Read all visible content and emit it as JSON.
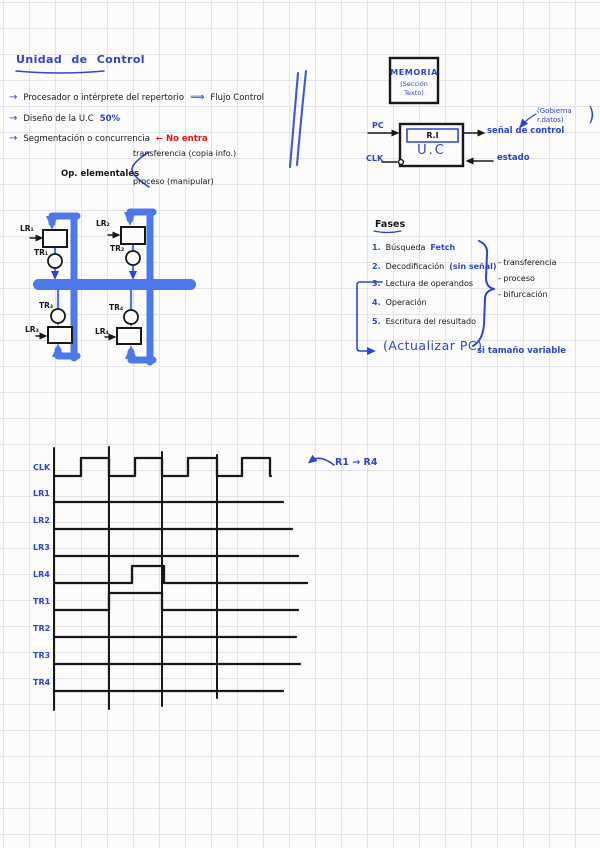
{
  "colors": {
    "ink_blue": "#2e46cf",
    "bus_blue": "#4d78ea",
    "ink_black": "#181818",
    "accent_red": "#e31616",
    "paper": "#fbfbfc",
    "grid": "#e4e4e8"
  },
  "notes": {
    "title": "Unidad de Control",
    "bullet1": {
      "arrow": "→",
      "text": "Procesador o intérprete del repertorio",
      "implies": "⟹",
      "tail": "Flujo Control"
    },
    "bullet2": {
      "arrow": "→",
      "text": "Diseño de la U.C",
      "highlight": "50%"
    },
    "bullet3": {
      "arrow": "→",
      "text": "Segmentación o concurrencia",
      "note": "← No entra"
    },
    "ops": {
      "label": "Op. elementales",
      "branch1": "transferencia (copia info.)",
      "branch2": "proceso (manipular)"
    }
  },
  "memory_diagram": {
    "box_title": "MEMORIA",
    "box_subtitle": "(Sección Texto)",
    "pc": "PC",
    "clk": "CLK",
    "ri": "R.I",
    "uc": "U.C",
    "signal_out": "señal de control",
    "signal_note": "(Gobierna r.datos)",
    "paren": ")",
    "state_out": "estado"
  },
  "register_diagram": {
    "labels": {
      "lr1": "LR₁",
      "tr1": "TR₁",
      "lr2": "LR₂",
      "tr2": "TR₂",
      "tr3": "TR₃",
      "lr3": "LR₃",
      "tr4": "TR₄",
      "lr4": "LR₄"
    }
  },
  "fases": {
    "title": "Fases",
    "items": [
      {
        "num": "1.",
        "text": "Búsqueda",
        "note": "Fetch"
      },
      {
        "num": "2.",
        "text": "Decodificación",
        "note": "(sin señal)"
      },
      {
        "num": "3.",
        "text": "Lectura de operandos",
        "note": ""
      },
      {
        "num": "4.",
        "text": "Operación",
        "note": ""
      },
      {
        "num": "5.",
        "text": "Escritura del resultado",
        "note": ""
      }
    ],
    "side_items": [
      "- transferencia",
      "- proceso",
      "- bifurcación"
    ],
    "footnote": {
      "main": "(Actualizar PC)",
      "detail": "si tamaño variable"
    }
  },
  "timing": {
    "type": "logic-waveform",
    "annotation": "R1 → R4",
    "x_start": 54,
    "clk_end": 270,
    "pulse_height": 17,
    "clock": {
      "name": "CLK",
      "baseline_y": 476,
      "high_y": 458,
      "edges": [
        81,
        109,
        135,
        162,
        188,
        217,
        242,
        270
      ]
    },
    "signals": [
      {
        "name": "LR1",
        "y": 502,
        "end": 283,
        "pulses": []
      },
      {
        "name": "LR2",
        "y": 529,
        "end": 292,
        "pulses": []
      },
      {
        "name": "LR3",
        "y": 556,
        "end": 298,
        "pulses": []
      },
      {
        "name": "LR4",
        "y": 583,
        "end": 307,
        "pulses": [
          [
            132,
            164
          ]
        ]
      },
      {
        "name": "TR1",
        "y": 610,
        "end": 298,
        "pulses": [
          [
            109,
            162
          ]
        ]
      },
      {
        "name": "TR2",
        "y": 637,
        "end": 296,
        "pulses": []
      },
      {
        "name": "TR3",
        "y": 664,
        "end": 300,
        "pulses": []
      },
      {
        "name": "TR4",
        "y": 691,
        "end": 283,
        "pulses": []
      }
    ],
    "dividers": [
      {
        "x": 109,
        "y1": 447,
        "y2": 709
      },
      {
        "x": 162,
        "y1": 452,
        "y2": 706
      },
      {
        "x": 217,
        "y1": 455,
        "y2": 698
      }
    ],
    "frame": {
      "x": 54,
      "y1": 448,
      "y2": 710
    }
  }
}
